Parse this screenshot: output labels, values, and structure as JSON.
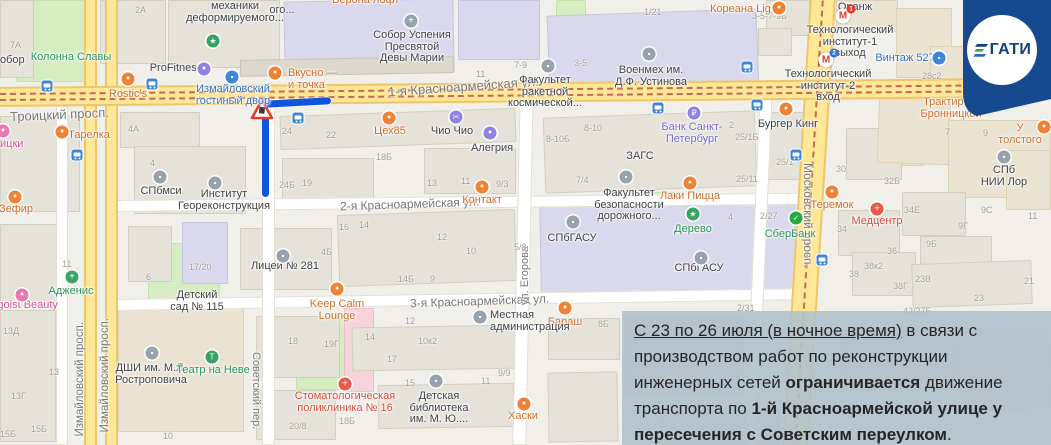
{
  "badge": {
    "text": "ГАТИ"
  },
  "annotation": {
    "lines": [
      [
        [
          "u",
          "С 23 по 26 июля (в ночное время)"
        ],
        [
          "n",
          " в связи с"
        ]
      ],
      [
        [
          "n",
          "производством работ по реконструкции"
        ]
      ],
      [
        [
          "n",
          "инженерных сетей "
        ],
        [
          "b",
          "ограничивается"
        ],
        [
          "n",
          " движение"
        ]
      ],
      [
        [
          "n",
          "транспорта по "
        ],
        [
          "b",
          "1-й Красноармейской улице у"
        ]
      ],
      [
        [
          "b",
          "пересечения с Советским переулком"
        ],
        [
          "n",
          "."
        ]
      ]
    ]
  },
  "map": {
    "palette": {
      "or": "#ef8234",
      "gr": "#3aa364",
      "bl": "#3f86d8",
      "pu": "#9183e2",
      "rd": "#e85948",
      "gy": "#98a2ad",
      "pk": "#e878b2",
      "sb": "#27a93d"
    },
    "label_colors": {
      "or": "#cf6d2a",
      "gr": "#28935a",
      "bl": "#2e74c9",
      "pu": "#7566d4",
      "rd": "#dc4a3a",
      "pk": "#d8569b",
      "dk": "#3f4247"
    },
    "street_labels": [
      {
        "t": "Троицкий просп.",
        "x": 10,
        "y": 107,
        "s": 13,
        "r": -2.5
      },
      {
        "t": "1-я Красноармейская ул.",
        "x": 388,
        "y": 79,
        "s": 13,
        "r": -4
      },
      {
        "t": "2-я Красноармейская ул.",
        "x": 340,
        "y": 197,
        "s": 12,
        "r": -2
      },
      {
        "t": "3-я Красноармейская ул.",
        "x": 410,
        "y": 294,
        "s": 12,
        "r": -2
      },
      {
        "t": "Измайловский просп.",
        "x": 74,
        "y": 322,
        "s": 11.5,
        "v": "up"
      },
      {
        "t": "Измайловский просп.",
        "x": 99,
        "y": 318,
        "s": 11.5,
        "v": "up"
      },
      {
        "t": "Советский пер.",
        "x": 250,
        "y": 352,
        "s": 11,
        "v": "down"
      },
      {
        "t": "ул. Егорова",
        "x": 519,
        "y": 246,
        "s": 11,
        "v": "up"
      },
      {
        "t": "Московский просп.",
        "x": 801,
        "y": 163,
        "s": 12,
        "v": "down"
      }
    ],
    "poi_labels": [
      {
        "t": "Колонна Славы",
        "x": 71,
        "y": 52,
        "c": "gr",
        "a": "c"
      },
      {
        "t": "ProFitness",
        "x": 176,
        "y": 63,
        "c": "dk",
        "a": "c"
      },
      {
        "t": "Rostic's",
        "x": 128,
        "y": 89,
        "c": "or",
        "a": "c"
      },
      {
        "t": "Измайловский\nгостиный двор",
        "x": 233,
        "y": 84,
        "c": "bl",
        "a": "c"
      },
      {
        "t": "Тарелка",
        "x": 89,
        "y": 130,
        "c": "or",
        "a": "c"
      },
      {
        "t": "Зефир",
        "x": 16,
        "y": 204,
        "c": "or",
        "a": "c"
      },
      {
        "t": "Вкусно —\nи точка",
        "x": 288,
        "y": 68,
        "c": "or",
        "a": "l"
      },
      {
        "t": "Цех85",
        "x": 390,
        "y": 126,
        "c": "or",
        "a": "c"
      },
      {
        "t": "Чио Чио",
        "x": 452,
        "y": 126,
        "c": "dk",
        "a": "c"
      },
      {
        "t": "Алегрия",
        "x": 492,
        "y": 143,
        "c": "dk",
        "a": "c"
      },
      {
        "t": "Собор Успения\nПресвятой\nДевы Марии",
        "x": 412,
        "y": 30,
        "c": "dk",
        "a": "c"
      },
      {
        "t": "Кореана Light",
        "x": 745,
        "y": 4,
        "c": "or",
        "a": "c"
      },
      {
        "t": "Военмех им.\nД.Ф. Устинова",
        "x": 651,
        "y": 65,
        "c": "dk",
        "a": "c"
      },
      {
        "t": "Факультет\nракетной\nкосмической...",
        "x": 545,
        "y": 75,
        "c": "dk",
        "a": "c"
      },
      {
        "t": "Банк Санкт-\nПетербург",
        "x": 692,
        "y": 122,
        "c": "pu",
        "a": "c"
      },
      {
        "t": "Бургер Кинг",
        "x": 788,
        "y": 119,
        "c": "dk",
        "a": "c"
      },
      {
        "t": "Оранж",
        "x": 855,
        "y": 2,
        "c": "dk",
        "a": "c"
      },
      {
        "t": "Технологический\nинститут-1\nвыход",
        "x": 850,
        "y": 25,
        "c": "dk",
        "a": "c"
      },
      {
        "t": "Технологический\nинститут-2\nвход",
        "x": 828,
        "y": 69,
        "c": "dk",
        "a": "c"
      },
      {
        "t": "Винтаж 527",
        "x": 905,
        "y": 53,
        "c": "bl",
        "a": "c"
      },
      {
        "t": "Трактир на\nБронницкой",
        "x": 951,
        "y": 97,
        "c": "or",
        "a": "c"
      },
      {
        "t": "У толстого",
        "x": 1020,
        "y": 123,
        "c": "or",
        "a": "c"
      },
      {
        "t": "СПб НИИ Лор",
        "x": 1004,
        "y": 165,
        "c": "dk",
        "a": "c"
      },
      {
        "t": "Теремок",
        "x": 832,
        "y": 200,
        "c": "or",
        "a": "c"
      },
      {
        "t": "Медцентр",
        "x": 877,
        "y": 216,
        "c": "rd",
        "a": "c"
      },
      {
        "t": "СПбмси",
        "x": 161,
        "y": 186,
        "c": "dk",
        "a": "c"
      },
      {
        "t": "Институт\nГеореконструкция",
        "x": 224,
        "y": 189,
        "c": "dk",
        "a": "c"
      },
      {
        "t": "Лицей № 281",
        "x": 285,
        "y": 261,
        "c": "dk",
        "a": "c"
      },
      {
        "t": "Контакт",
        "x": 482,
        "y": 195,
        "c": "or",
        "a": "c"
      },
      {
        "t": "ЗАГС",
        "x": 640,
        "y": 151,
        "c": "dk",
        "a": "c"
      },
      {
        "t": "Факультет\nбезопасности\nдорожного...",
        "x": 629,
        "y": 188,
        "c": "dk",
        "a": "c"
      },
      {
        "t": "Лаки Пицца",
        "x": 690,
        "y": 191,
        "c": "or",
        "a": "c"
      },
      {
        "t": "Дерево",
        "x": 693,
        "y": 224,
        "c": "gr",
        "a": "c"
      },
      {
        "t": "СПбГАСУ",
        "x": 572,
        "y": 233,
        "c": "dk",
        "a": "c"
      },
      {
        "t": "СПбГАСУ",
        "x": 699,
        "y": 263,
        "c": "dk",
        "a": "c"
      },
      {
        "t": "СберБанк",
        "x": 790,
        "y": 229,
        "c": "gr",
        "a": "c"
      },
      {
        "t": "Бараш",
        "x": 565,
        "y": 317,
        "c": "or",
        "a": "c"
      },
      {
        "t": "Keep Calm\nLounge",
        "x": 337,
        "y": 299,
        "c": "or",
        "a": "c"
      },
      {
        "t": "Местная\nадминистрация",
        "x": 490,
        "y": 310,
        "c": "dk",
        "a": "l"
      },
      {
        "t": "Стоматологическая\nполиклиника № 16",
        "x": 345,
        "y": 391,
        "c": "rd",
        "a": "c"
      },
      {
        "t": "Детская\nбиблиотека\nим. М. Ю....",
        "x": 439,
        "y": 391,
        "c": "dk",
        "a": "c"
      },
      {
        "t": "Хаски",
        "x": 523,
        "y": 411,
        "c": "or",
        "a": "c"
      },
      {
        "t": "Egoist Beauty",
        "x": 24,
        "y": 300,
        "c": "pk",
        "a": "c"
      },
      {
        "t": "Адженис",
        "x": 71,
        "y": 286,
        "c": "gr",
        "a": "c"
      },
      {
        "t": "Детский\nсад № 115",
        "x": 197,
        "y": 290,
        "c": "dk",
        "a": "c"
      },
      {
        "t": "ДШИ им. М.Л.\nРостроповича",
        "x": 151,
        "y": 363,
        "c": "dk",
        "a": "c"
      },
      {
        "t": "Театр на Неве",
        "x": 213,
        "y": 365,
        "c": "gr",
        "a": "c"
      },
      {
        "t": "механики\nдеформируемого...",
        "x": 235,
        "y": 1,
        "c": "dk",
        "a": "c"
      },
      {
        "t": "обор",
        "x": 0,
        "y": 55,
        "c": "dk",
        "a": "l"
      },
      {
        "t": "Верона лофт",
        "x": 332,
        "y": -5,
        "c": "or",
        "a": "l"
      },
      {
        "t": "ицки",
        "x": 0,
        "y": 139,
        "c": "pk",
        "a": "l"
      },
      {
        "t": "ого...",
        "x": 282,
        "y": 5,
        "c": "dk",
        "a": "c"
      }
    ],
    "poi_icons": [
      {
        "x": 213,
        "y": 41,
        "c": "gr",
        "g": "★"
      },
      {
        "x": 204,
        "y": 69,
        "c": "pu",
        "g": "•"
      },
      {
        "x": 128,
        "y": 79,
        "c": "or",
        "g": "•"
      },
      {
        "x": 232,
        "y": 77,
        "c": "bl",
        "g": "▪"
      },
      {
        "x": 62,
        "y": 132,
        "c": "or",
        "g": "•"
      },
      {
        "x": 15,
        "y": 197,
        "c": "or",
        "g": "•"
      },
      {
        "x": 275,
        "y": 73,
        "c": "or",
        "g": "•"
      },
      {
        "x": 389,
        "y": 118,
        "c": "or",
        "g": "•"
      },
      {
        "x": 456,
        "y": 117,
        "c": "pu",
        "g": "✂"
      },
      {
        "x": 490,
        "y": 133,
        "c": "pu",
        "g": "•"
      },
      {
        "x": 411,
        "y": 21,
        "c": "gy",
        "g": "+"
      },
      {
        "x": 779,
        "y": 8,
        "c": "or",
        "g": "•"
      },
      {
        "x": 649,
        "y": 54,
        "c": "gy",
        "g": "▪"
      },
      {
        "x": 548,
        "y": 66,
        "c": "gy",
        "g": "▪"
      },
      {
        "x": 694,
        "y": 113,
        "c": "pu",
        "g": "₽"
      },
      {
        "x": 786,
        "y": 109,
        "c": "or",
        "g": "•"
      },
      {
        "x": 939,
        "y": 58,
        "c": "bl",
        "g": "▪"
      },
      {
        "x": 981,
        "y": 105,
        "c": "or",
        "g": "•"
      },
      {
        "x": 1044,
        "y": 127,
        "c": "or",
        "g": "•"
      },
      {
        "x": 1004,
        "y": 157,
        "c": "gy",
        "g": "▪"
      },
      {
        "x": 832,
        "y": 192,
        "c": "or",
        "g": "•"
      },
      {
        "x": 877,
        "y": 209,
        "c": "rd",
        "g": "+"
      },
      {
        "x": 160,
        "y": 177,
        "c": "gy",
        "g": "▪"
      },
      {
        "x": 215,
        "y": 183,
        "c": "gy",
        "g": "▪"
      },
      {
        "x": 283,
        "y": 256,
        "c": "gy",
        "g": "▪"
      },
      {
        "x": 482,
        "y": 187,
        "c": "or",
        "g": "•"
      },
      {
        "x": 626,
        "y": 177,
        "c": "gy",
        "g": "▪"
      },
      {
        "x": 690,
        "y": 183,
        "c": "or",
        "g": "•"
      },
      {
        "x": 693,
        "y": 214,
        "c": "gr",
        "g": "★"
      },
      {
        "x": 573,
        "y": 222,
        "c": "gy",
        "g": "▪"
      },
      {
        "x": 701,
        "y": 258,
        "c": "gy",
        "g": "▪"
      },
      {
        "x": 796,
        "y": 218,
        "c": "sb",
        "g": "✓"
      },
      {
        "x": 565,
        "y": 308,
        "c": "or",
        "g": "•"
      },
      {
        "x": 337,
        "y": 289,
        "c": "or",
        "g": "•"
      },
      {
        "x": 480,
        "y": 317,
        "c": "gy",
        "g": "▪"
      },
      {
        "x": 345,
        "y": 384,
        "c": "rd",
        "g": "+"
      },
      {
        "x": 436,
        "y": 381,
        "c": "gy",
        "g": "▪"
      },
      {
        "x": 524,
        "y": 404,
        "c": "or",
        "g": "•"
      },
      {
        "x": 22,
        "y": 295,
        "c": "pk",
        "g": "•"
      },
      {
        "x": 72,
        "y": 277,
        "c": "gr",
        "g": "+"
      },
      {
        "x": 152,
        "y": 353,
        "c": "gy",
        "g": "▪"
      },
      {
        "x": 212,
        "y": 357,
        "c": "gr",
        "g": "Т"
      },
      {
        "x": 3,
        "y": 131,
        "c": "pk",
        "g": "•"
      }
    ],
    "metro": [
      {
        "x": 843,
        "y": 16,
        "n": "1",
        "c": "#e03a2f"
      },
      {
        "x": 826,
        "y": 60,
        "n": "2",
        "c": "#2f6fd8"
      }
    ],
    "bus_stops": [
      [
        47,
        86
      ],
      [
        152,
        84
      ],
      [
        298,
        118
      ],
      [
        658,
        108
      ],
      [
        747,
        67
      ],
      [
        757,
        105
      ],
      [
        77,
        155
      ],
      [
        822,
        260
      ],
      [
        796,
        155
      ]
    ],
    "building_numbers": [
      [
        "7А",
        10,
        40
      ],
      [
        "2А",
        135,
        5
      ],
      [
        "4А",
        128,
        124
      ],
      [
        "3-5-7-9Б",
        752,
        11
      ],
      [
        "7-9",
        514,
        60
      ],
      [
        "11",
        476,
        69
      ],
      [
        "1/21",
        644,
        7
      ],
      [
        "3-5",
        574,
        58
      ],
      [
        "8-10",
        584,
        123
      ],
      [
        "8-10Б",
        546,
        134
      ],
      [
        "2",
        729,
        120
      ],
      [
        "25/1Б",
        735,
        132
      ],
      [
        "28с2",
        922,
        71
      ],
      [
        "24",
        282,
        126
      ],
      [
        "22",
        326,
        130
      ],
      [
        "24Б",
        279,
        180
      ],
      [
        "19",
        302,
        178
      ],
      [
        "18Б",
        376,
        152
      ],
      [
        "13",
        427,
        178
      ],
      [
        "11",
        461,
        176
      ],
      [
        "9/3",
        496,
        179
      ],
      [
        "16",
        339,
        222
      ],
      [
        "14",
        359,
        220
      ],
      [
        "12",
        437,
        232
      ],
      [
        "10",
        466,
        246
      ],
      [
        "5/8",
        514,
        242
      ],
      [
        "14Б",
        398,
        274
      ],
      [
        "9",
        430,
        274
      ],
      [
        "4Б",
        321,
        247
      ],
      [
        "7/4",
        576,
        175
      ],
      [
        "25/1",
        776,
        157
      ],
      [
        "25/11",
        736,
        174
      ],
      [
        "4",
        728,
        212
      ],
      [
        "2/27",
        760,
        211
      ],
      [
        "12",
        405,
        316
      ],
      [
        "14",
        365,
        332
      ],
      [
        "17",
        387,
        354
      ],
      [
        "10к2",
        418,
        336
      ],
      [
        "15",
        405,
        378
      ],
      [
        "11",
        481,
        376
      ],
      [
        "9/9",
        498,
        368
      ],
      [
        "18",
        288,
        336
      ],
      [
        "19Г",
        324,
        339
      ],
      [
        "18Б",
        339,
        416
      ],
      [
        "20/8",
        289,
        421
      ],
      [
        "13Д",
        3,
        326
      ],
      [
        "13",
        49,
        367
      ],
      [
        "13Г",
        11,
        391
      ],
      [
        "15Б",
        31,
        424
      ],
      [
        "15Б",
        0,
        429
      ],
      [
        "10",
        163,
        431
      ],
      [
        "30",
        836,
        164
      ],
      [
        "32Б",
        884,
        176
      ],
      [
        "34Е",
        904,
        205
      ],
      [
        "34",
        837,
        224
      ],
      [
        "36",
        887,
        246
      ],
      [
        "9С",
        981,
        205
      ],
      [
        "9Г",
        958,
        221
      ],
      [
        "9Б",
        926,
        239
      ],
      [
        "11",
        1028,
        211
      ],
      [
        "7",
        945,
        127
      ],
      [
        "9",
        983,
        128
      ],
      [
        "23В",
        915,
        274
      ],
      [
        "23",
        974,
        293
      ],
      [
        "21",
        1024,
        276
      ],
      [
        "38к2",
        864,
        261
      ],
      [
        "38",
        849,
        269
      ],
      [
        "38Г",
        893,
        281
      ],
      [
        "42/27Б",
        903,
        306
      ],
      [
        "2/31",
        737,
        303
      ],
      [
        "17/20",
        189,
        262
      ],
      [
        "11",
        62,
        259
      ],
      [
        "6",
        146,
        272
      ],
      [
        "4",
        150,
        158
      ],
      [
        "8Б",
        598,
        319
      ]
    ]
  }
}
